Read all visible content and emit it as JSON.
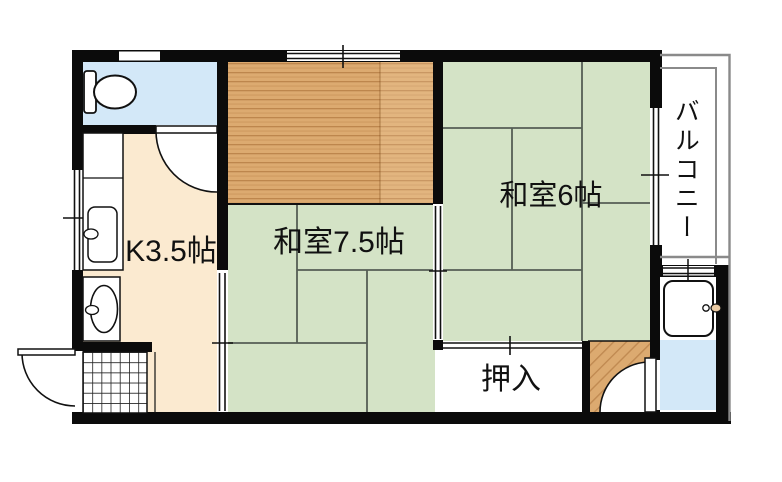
{
  "floor_plan": {
    "rooms": {
      "kitchen": {
        "label": "K3.5帖"
      },
      "japanese_room_7_5": {
        "label": "和室7.5帖"
      },
      "japanese_room_6": {
        "label": "和室6帖"
      },
      "closet": {
        "label": "押入"
      },
      "balcony": {
        "label": "バルコニー"
      }
    },
    "colors": {
      "tatami": "#d4e3c6",
      "wood": "#dcaa70",
      "kitchen_floor": "#fbead0",
      "water_area": "#d3e8f8",
      "wall": "#0b0b0b",
      "balcony_line": "#8a8a8a",
      "tatami_line": "#4f574f",
      "faucet_accent": "#e9c9a2"
    }
  }
}
